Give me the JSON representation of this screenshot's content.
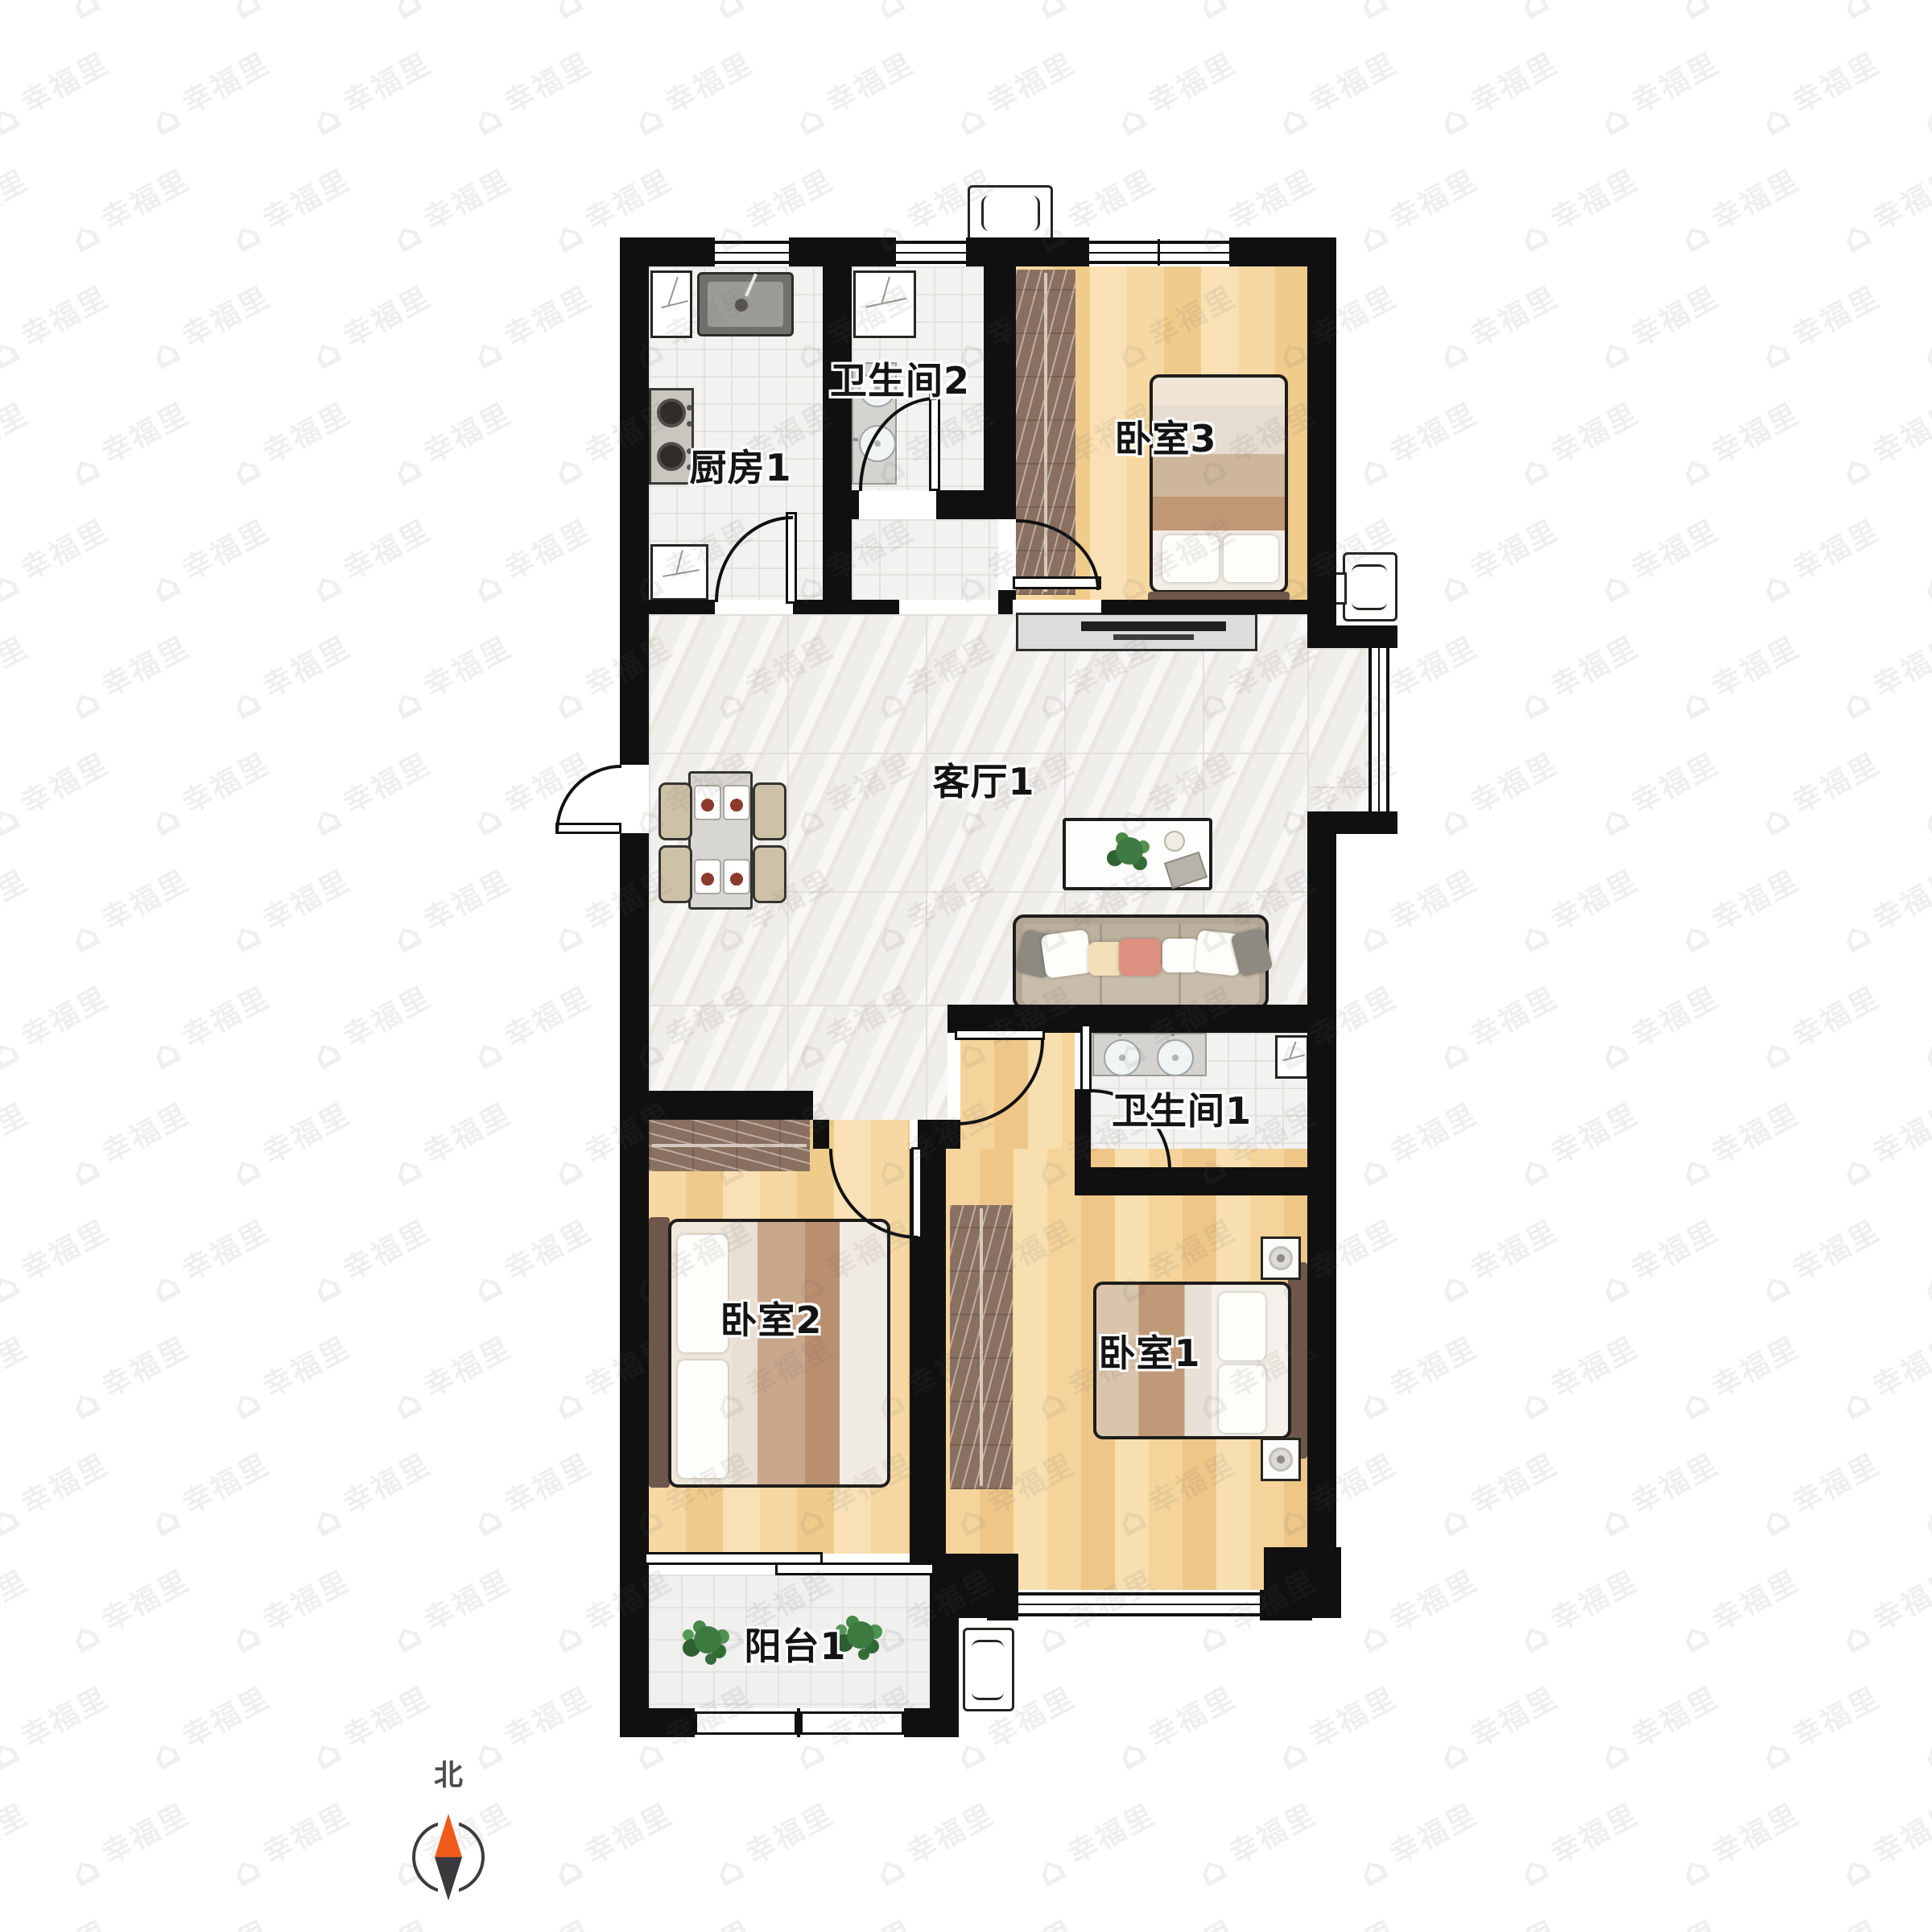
{
  "rooms": [
    {
      "name": "kitchen",
      "label": "厨房1"
    },
    {
      "name": "bathroom-2",
      "label": "卫生间2"
    },
    {
      "name": "bedroom-3",
      "label": "卧室3"
    },
    {
      "name": "living-room",
      "label": "客厅1"
    },
    {
      "name": "bathroom-1",
      "label": "卫生间1"
    },
    {
      "name": "bedroom-2",
      "label": "卧室2"
    },
    {
      "name": "bedroom-1",
      "label": "卧室1"
    },
    {
      "name": "balcony",
      "label": "阳台1"
    }
  ],
  "compass": {
    "north_label": "北"
  },
  "watermark": {
    "text": "幸福里"
  },
  "colors": {
    "wall": "#101010",
    "marble": "#f0eeea",
    "tile": "#f3f2f0",
    "wardrobe": "#8a7060",
    "sofa": "#b2a794",
    "compass-north": "#f05a1a",
    "compass-south": "#3a3a3e"
  }
}
